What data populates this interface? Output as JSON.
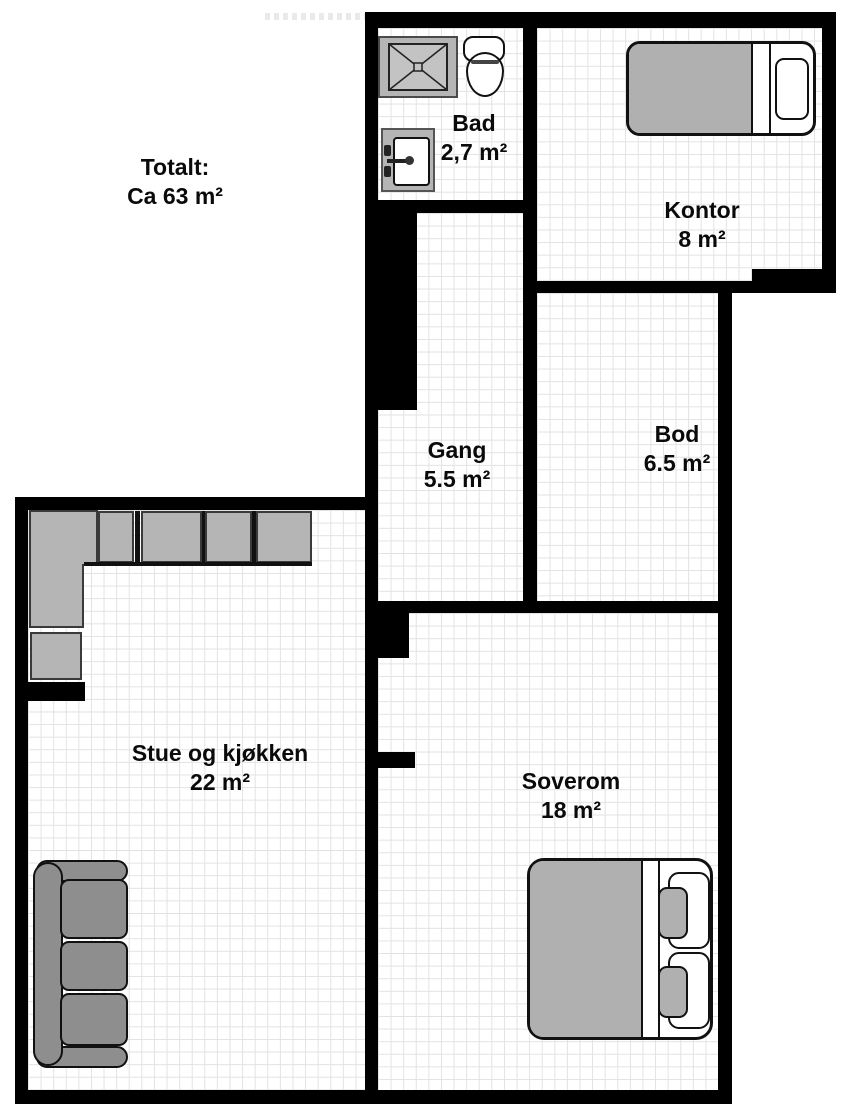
{
  "total": {
    "label": "Totalt:",
    "value": "Ca 63 m²"
  },
  "rooms": {
    "bad": {
      "name": "Bad",
      "area": "2,7 m²"
    },
    "kontor": {
      "name": "Kontor",
      "area": "8 m²"
    },
    "gang": {
      "name": "Gang",
      "area": "5.5 m²"
    },
    "bod": {
      "name": "Bod",
      "area": "6.5 m²"
    },
    "stue": {
      "name": "Stue og kjøkken",
      "area": "22 m²"
    },
    "soverom": {
      "name": "Soverom",
      "area": "18 m²"
    }
  },
  "colors": {
    "wall": "#000000",
    "floor": "#ffffff",
    "grid": "#e2e2e2",
    "cabinet_gray": "#b5b5b5",
    "sofa_gray": "#8e8e8e",
    "duvet_gray": "#b0b0b0",
    "outline": "#111111"
  }
}
